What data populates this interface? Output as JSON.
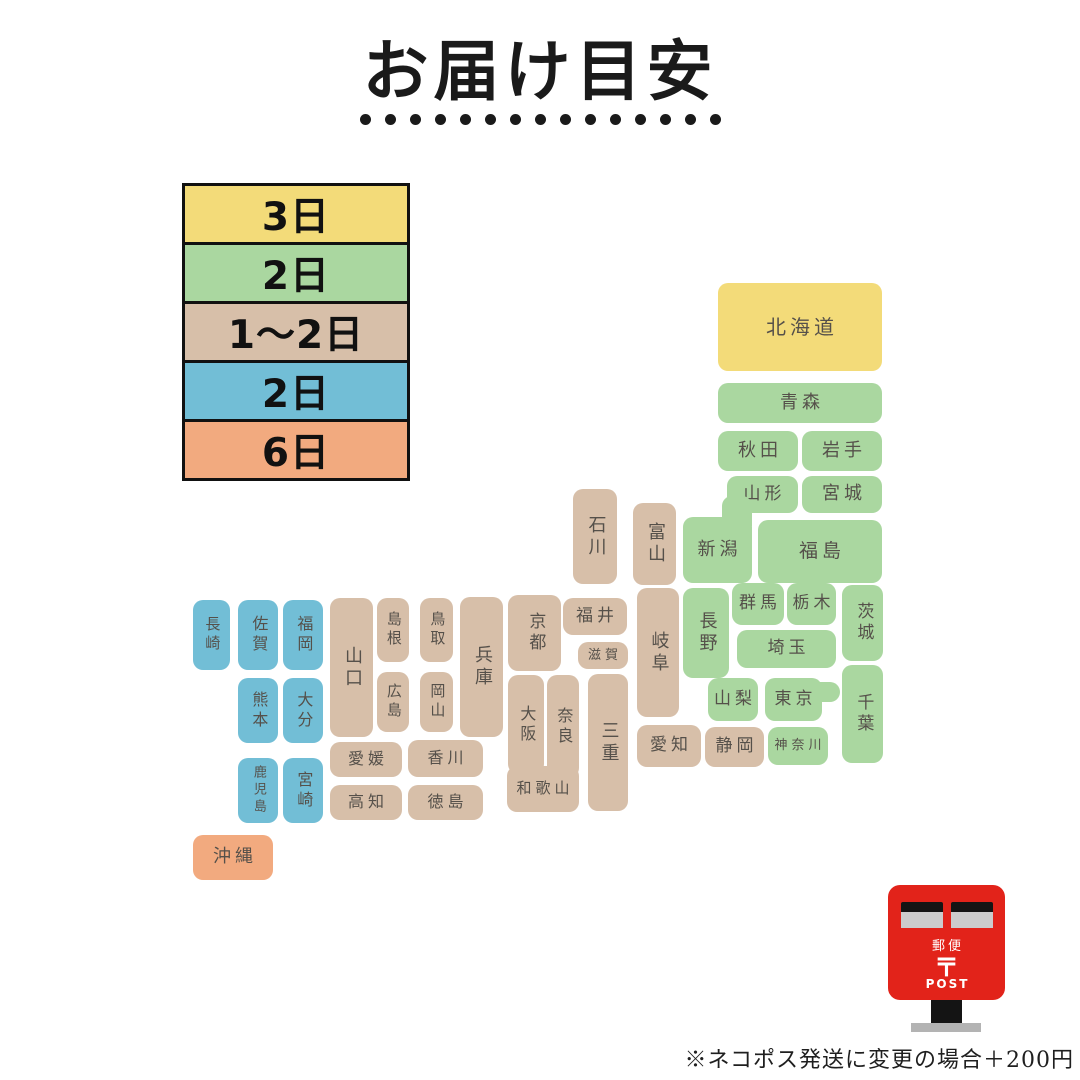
{
  "title": "お届け目安",
  "title_dots": 15,
  "footnote": "※ネコポス発送に変更の場合＋200円",
  "colors": {
    "yellow": "#f3db79",
    "green": "#aad7a0",
    "tan": "#d7bfa9",
    "blue": "#72bed6",
    "orange": "#f2aa7f",
    "block_text": "#55504a",
    "legend_border": "#111111",
    "postbox_red": "#e2231a"
  },
  "legend": [
    {
      "label": "3日",
      "color_key": "yellow"
    },
    {
      "label": "2日",
      "color_key": "green"
    },
    {
      "label": "1〜2日",
      "color_key": "tan"
    },
    {
      "label": "2日",
      "color_key": "blue"
    },
    {
      "label": "6日",
      "color_key": "orange"
    }
  ],
  "postbox": {
    "yubin": "郵便",
    "mark": "〒",
    "post": "POST"
  },
  "map_blocks": [
    {
      "id": "hokkaido",
      "label": "北海道",
      "x": 718,
      "y": 283,
      "w": 164,
      "h": 88,
      "color": "yellow",
      "orient": "h",
      "fs": 20
    },
    {
      "id": "aomori",
      "label": "青森",
      "x": 718,
      "y": 383,
      "w": 164,
      "h": 40,
      "color": "green",
      "orient": "h",
      "fs": 18
    },
    {
      "id": "akita",
      "label": "秋田",
      "x": 718,
      "y": 431,
      "w": 80,
      "h": 40,
      "color": "green",
      "orient": "h",
      "fs": 18
    },
    {
      "id": "iwate",
      "label": "岩手",
      "x": 802,
      "y": 431,
      "w": 80,
      "h": 40,
      "color": "green",
      "orient": "h",
      "fs": 18
    },
    {
      "id": "yamagata",
      "label": "山形",
      "x": 727,
      "y": 476,
      "w": 71,
      "h": 37,
      "color": "green",
      "orient": "h",
      "fs": 17
    },
    {
      "id": "miyagi",
      "label": "宮城",
      "x": 802,
      "y": 476,
      "w": 80,
      "h": 37,
      "color": "green",
      "orient": "h",
      "fs": 18
    },
    {
      "id": "niigata",
      "label": "新潟",
      "x": 683,
      "y": 517,
      "w": 69,
      "h": 66,
      "color": "green",
      "orient": "h",
      "fs": 18,
      "ext": {
        "x": 722,
        "y": 496,
        "w": 30,
        "h": 30,
        "r": "10px 10px 0 0"
      }
    },
    {
      "id": "fukushima",
      "label": "福島",
      "x": 758,
      "y": 520,
      "w": 124,
      "h": 63,
      "color": "green",
      "orient": "h",
      "fs": 19
    },
    {
      "id": "ishikawa",
      "label": "石川",
      "x": 573,
      "y": 489,
      "w": 44,
      "h": 95,
      "color": "tan",
      "orient": "v",
      "fs": 18
    },
    {
      "id": "toyama",
      "label": "富山",
      "x": 633,
      "y": 503,
      "w": 43,
      "h": 82,
      "color": "tan",
      "orient": "v",
      "fs": 18
    },
    {
      "id": "nagano",
      "label": "長野",
      "x": 683,
      "y": 588,
      "w": 46,
      "h": 90,
      "color": "green",
      "orient": "v",
      "fs": 18
    },
    {
      "id": "gunma",
      "label": "群馬",
      "x": 732,
      "y": 583,
      "w": 52,
      "h": 42,
      "color": "green",
      "orient": "h",
      "fs": 17
    },
    {
      "id": "tochigi",
      "label": "栃木",
      "x": 787,
      "y": 583,
      "w": 49,
      "h": 42,
      "color": "green",
      "orient": "h",
      "fs": 17
    },
    {
      "id": "ibaraki",
      "label": "茨城",
      "x": 842,
      "y": 585,
      "w": 41,
      "h": 76,
      "color": "green",
      "orient": "v",
      "fs": 17
    },
    {
      "id": "saitama",
      "label": "埼玉",
      "x": 737,
      "y": 630,
      "w": 99,
      "h": 38,
      "color": "green",
      "orient": "h",
      "fs": 17
    },
    {
      "id": "yamanashi",
      "label": "山梨",
      "x": 708,
      "y": 678,
      "w": 50,
      "h": 43,
      "color": "green",
      "orient": "h",
      "fs": 17
    },
    {
      "id": "tokyo",
      "label": "東京",
      "x": 765,
      "y": 678,
      "w": 57,
      "h": 43,
      "color": "green",
      "orient": "h",
      "fs": 17,
      "ext": {
        "x": 816,
        "y": 682,
        "w": 24,
        "h": 20,
        "r": "0 10px 10px 0"
      }
    },
    {
      "id": "chiba",
      "label": "千葉",
      "x": 842,
      "y": 665,
      "w": 41,
      "h": 98,
      "color": "green",
      "orient": "v",
      "fs": 17
    },
    {
      "id": "kanagawa",
      "label": "神奈川",
      "x": 768,
      "y": 727,
      "w": 60,
      "h": 38,
      "color": "green",
      "orient": "h",
      "fs": 13
    },
    {
      "id": "shizuoka",
      "label": "静岡",
      "x": 705,
      "y": 727,
      "w": 59,
      "h": 40,
      "color": "tan",
      "orient": "h",
      "fs": 17
    },
    {
      "id": "fukui",
      "label": "福井",
      "x": 563,
      "y": 598,
      "w": 64,
      "h": 37,
      "color": "tan",
      "orient": "h",
      "fs": 17
    },
    {
      "id": "shiga",
      "label": "滋賀",
      "x": 578,
      "y": 642,
      "w": 50,
      "h": 27,
      "color": "tan",
      "orient": "h",
      "fs": 13
    },
    {
      "id": "kyoto",
      "label": "京都",
      "x": 508,
      "y": 595,
      "w": 53,
      "h": 76,
      "color": "tan",
      "orient": "v",
      "fs": 17
    },
    {
      "id": "gifu",
      "label": "岐阜",
      "x": 637,
      "y": 588,
      "w": 42,
      "h": 129,
      "color": "tan",
      "orient": "v",
      "fs": 18
    },
    {
      "id": "aichi",
      "label": "愛知",
      "x": 637,
      "y": 725,
      "w": 64,
      "h": 42,
      "color": "tan",
      "orient": "h",
      "fs": 17
    },
    {
      "id": "mie",
      "label": "三重",
      "x": 588,
      "y": 674,
      "w": 40,
      "h": 137,
      "color": "tan",
      "orient": "v",
      "fs": 18
    },
    {
      "id": "nara",
      "label": "奈良",
      "x": 547,
      "y": 675,
      "w": 32,
      "h": 103,
      "color": "tan",
      "orient": "v",
      "fs": 16
    },
    {
      "id": "osaka",
      "label": "大阪",
      "x": 508,
      "y": 675,
      "w": 36,
      "h": 99,
      "color": "tan",
      "orient": "v",
      "fs": 16
    },
    {
      "id": "wakayama",
      "label": "和歌山",
      "x": 507,
      "y": 766,
      "w": 72,
      "h": 46,
      "color": "tan",
      "orient": "h",
      "fs": 15
    },
    {
      "id": "hyogo",
      "label": "兵庫",
      "x": 460,
      "y": 597,
      "w": 43,
      "h": 140,
      "color": "tan",
      "orient": "v",
      "fs": 18
    },
    {
      "id": "tottori",
      "label": "鳥取",
      "x": 420,
      "y": 598,
      "w": 33,
      "h": 64,
      "color": "tan",
      "orient": "v",
      "fs": 15
    },
    {
      "id": "okayama",
      "label": "岡山",
      "x": 420,
      "y": 672,
      "w": 33,
      "h": 60,
      "color": "tan",
      "orient": "v",
      "fs": 15
    },
    {
      "id": "shimane",
      "label": "島根",
      "x": 377,
      "y": 598,
      "w": 32,
      "h": 64,
      "color": "tan",
      "orient": "v",
      "fs": 15
    },
    {
      "id": "hiroshima",
      "label": "広島",
      "x": 377,
      "y": 672,
      "w": 32,
      "h": 60,
      "color": "tan",
      "orient": "v",
      "fs": 15
    },
    {
      "id": "yamaguchi",
      "label": "山口",
      "x": 330,
      "y": 598,
      "w": 43,
      "h": 139,
      "color": "tan",
      "orient": "v",
      "fs": 18
    },
    {
      "id": "ehime",
      "label": "愛媛",
      "x": 330,
      "y": 742,
      "w": 72,
      "h": 35,
      "color": "tan",
      "orient": "h",
      "fs": 16
    },
    {
      "id": "kagawa",
      "label": "香川",
      "x": 408,
      "y": 740,
      "w": 75,
      "h": 37,
      "color": "tan",
      "orient": "h",
      "fs": 16
    },
    {
      "id": "kochi",
      "label": "高知",
      "x": 330,
      "y": 785,
      "w": 72,
      "h": 35,
      "color": "tan",
      "orient": "h",
      "fs": 16
    },
    {
      "id": "tokushima",
      "label": "徳島",
      "x": 408,
      "y": 785,
      "w": 75,
      "h": 35,
      "color": "tan",
      "orient": "h",
      "fs": 16
    },
    {
      "id": "nagasaki",
      "label": "長崎",
      "x": 193,
      "y": 600,
      "w": 37,
      "h": 70,
      "color": "blue",
      "orient": "v",
      "fs": 15
    },
    {
      "id": "saga",
      "label": "佐賀",
      "x": 238,
      "y": 600,
      "w": 40,
      "h": 70,
      "color": "blue",
      "orient": "v",
      "fs": 16
    },
    {
      "id": "fukuoka",
      "label": "福岡",
      "x": 283,
      "y": 600,
      "w": 40,
      "h": 70,
      "color": "blue",
      "orient": "v",
      "fs": 16
    },
    {
      "id": "kumamoto",
      "label": "熊本",
      "x": 238,
      "y": 678,
      "w": 40,
      "h": 65,
      "color": "blue",
      "orient": "v",
      "fs": 16
    },
    {
      "id": "oita",
      "label": "大分",
      "x": 283,
      "y": 678,
      "w": 40,
      "h": 65,
      "color": "blue",
      "orient": "v",
      "fs": 16
    },
    {
      "id": "kagoshima",
      "label": "鹿児島",
      "x": 238,
      "y": 758,
      "w": 40,
      "h": 65,
      "color": "blue",
      "orient": "v",
      "fs": 13
    },
    {
      "id": "miyazaki",
      "label": "宮崎",
      "x": 283,
      "y": 758,
      "w": 40,
      "h": 65,
      "color": "blue",
      "orient": "v",
      "fs": 16
    },
    {
      "id": "okinawa",
      "label": "沖縄",
      "x": 193,
      "y": 835,
      "w": 80,
      "h": 45,
      "color": "orange",
      "orient": "h",
      "fs": 18
    }
  ]
}
